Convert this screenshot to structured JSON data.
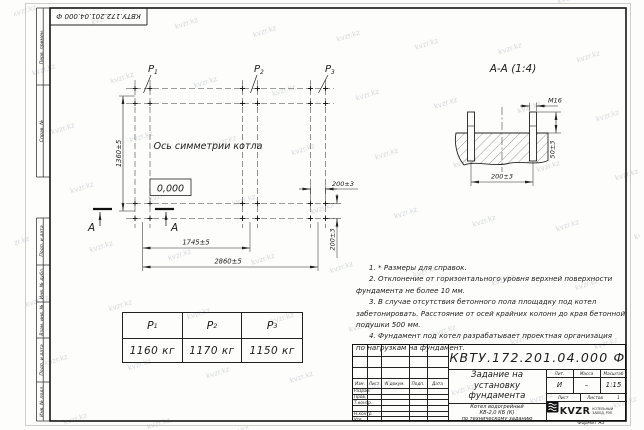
{
  "watermark": "kvzr.kz",
  "orientation_stamp": "КВТУ.172.201.04.000 Ф",
  "margin_labels": {
    "perv_primen": "Перв. примен.",
    "sprav_no": "Справ. №",
    "podp_data_1": "Подп. и дата",
    "inv_dubl": "Инв. № дубл.",
    "vzam_inv": "Взам. инв. №",
    "podp_data_2": "Подп. и дата",
    "inv_podl": "Инв. № подл."
  },
  "plan": {
    "labels": [
      {
        "base": "P",
        "sub": "1"
      },
      {
        "base": "P",
        "sub": "2"
      },
      {
        "base": "P",
        "sub": "3"
      }
    ],
    "axis_label": "Ось симметрии котла",
    "elevation": "0,000",
    "dim_height": "1360±5",
    "dim_span_mid": "1745±5",
    "dim_span_full": "2860±5",
    "dim_bolt_h": "200±3",
    "dim_bolt_v": "200±3",
    "section_mark": "А"
  },
  "section": {
    "title": "А-А (1:4)",
    "thread": "М16",
    "dim_height": "50±3",
    "dim_span": "200±3"
  },
  "load_table": {
    "headers": [
      {
        "base": "P",
        "sub": "1"
      },
      {
        "base": "P",
        "sub": "2"
      },
      {
        "base": "P",
        "sub": "3"
      }
    ],
    "values": [
      "1160 кг",
      "1170 кг",
      "1150 кг"
    ]
  },
  "notes": {
    "lines": [
      "1. * Размеры для справок.",
      "2. Отклонение от горизонтального уровня верхней поверхности",
      "фундамента не более 10 мм.",
      "3. В случае отсутствия бетонного пола площадку под котел",
      "забетонировать. Расстояние от осей крайних колонн до края бетонной",
      "подушки 500 мм.",
      "4. Фундамент под котел разрабатывает проектная организация",
      "по нагрузкам на фундамент."
    ]
  },
  "title_block": {
    "doc_number": "КВТУ.172.201.04.000 Ф",
    "title_lines": [
      "Задание на",
      "установку",
      "фундамента"
    ],
    "product_lines": [
      "Котел водогрейный",
      "КВ-2,0 КБ (К)",
      "по техническому заданию"
    ],
    "rev_header": [
      "Изм.",
      "Лист",
      "N докум.",
      "Подп.",
      "Дата"
    ],
    "sign_rows": [
      "Разраб.",
      "Пров.",
      "Т.контр.",
      "",
      "Н.контр.",
      "Утв."
    ],
    "lit_header": [
      "Лит.",
      "Масса",
      "Масштаб"
    ],
    "lit_value": "И",
    "mass_value": "–",
    "scale_value": "1:15",
    "sheet_label": "Лист",
    "sheets_label": "Листов",
    "sheets_value": "1",
    "logo_text": "KVZR",
    "logo_org": [
      "КОТЕЛЬНЫЙ",
      "ЗАВОД, РЭП"
    ],
    "format_label": "Формат А3"
  }
}
